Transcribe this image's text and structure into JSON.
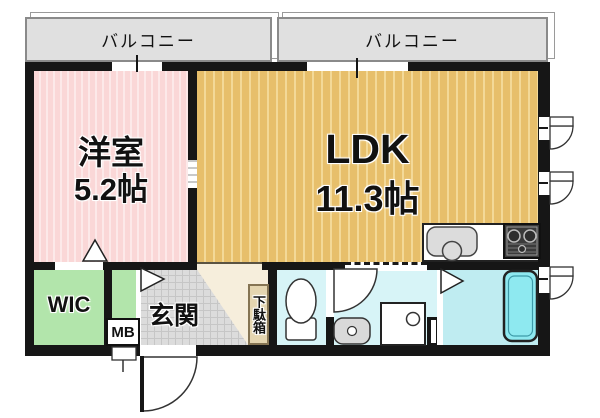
{
  "plan_title": "1LDK floor plan",
  "balconies": [
    {
      "label": "バルコニー"
    },
    {
      "label": "バルコニー"
    }
  ],
  "rooms": {
    "western_room": {
      "name": "洋室",
      "area": "5.2帖"
    },
    "ldk": {
      "name": "LDK",
      "area": "11.3帖"
    },
    "wic": {
      "label": "WIC"
    },
    "genkan": {
      "label": "玄関"
    },
    "meter_box": {
      "label": "MB"
    },
    "shoe_cabinet": {
      "label": "下駄箱"
    }
  },
  "fixtures": {
    "toilet": "toilet",
    "washbasin": "washbasin",
    "washing_machine": "washing-machine-space",
    "bathtub": "bathtub",
    "kitchen_sink": "kitchen-sink",
    "gas_stove": "gas-stove",
    "entrance_door": "entrance-door-swing",
    "windows": "outswing-windows"
  },
  "colors": {
    "wall": "#161616",
    "western_room": "#fad7d7",
    "ldk": "#e7bf6b",
    "closet_green": "#b2e5ab",
    "hall_beige": "#f6eedc",
    "tile_gray": "#dcdcdc",
    "wet_area": "#d7f4f7",
    "bath_floor": "#bfecf1",
    "bathtub": "#8ee9f0",
    "balcony": "#e0e0e0"
  }
}
